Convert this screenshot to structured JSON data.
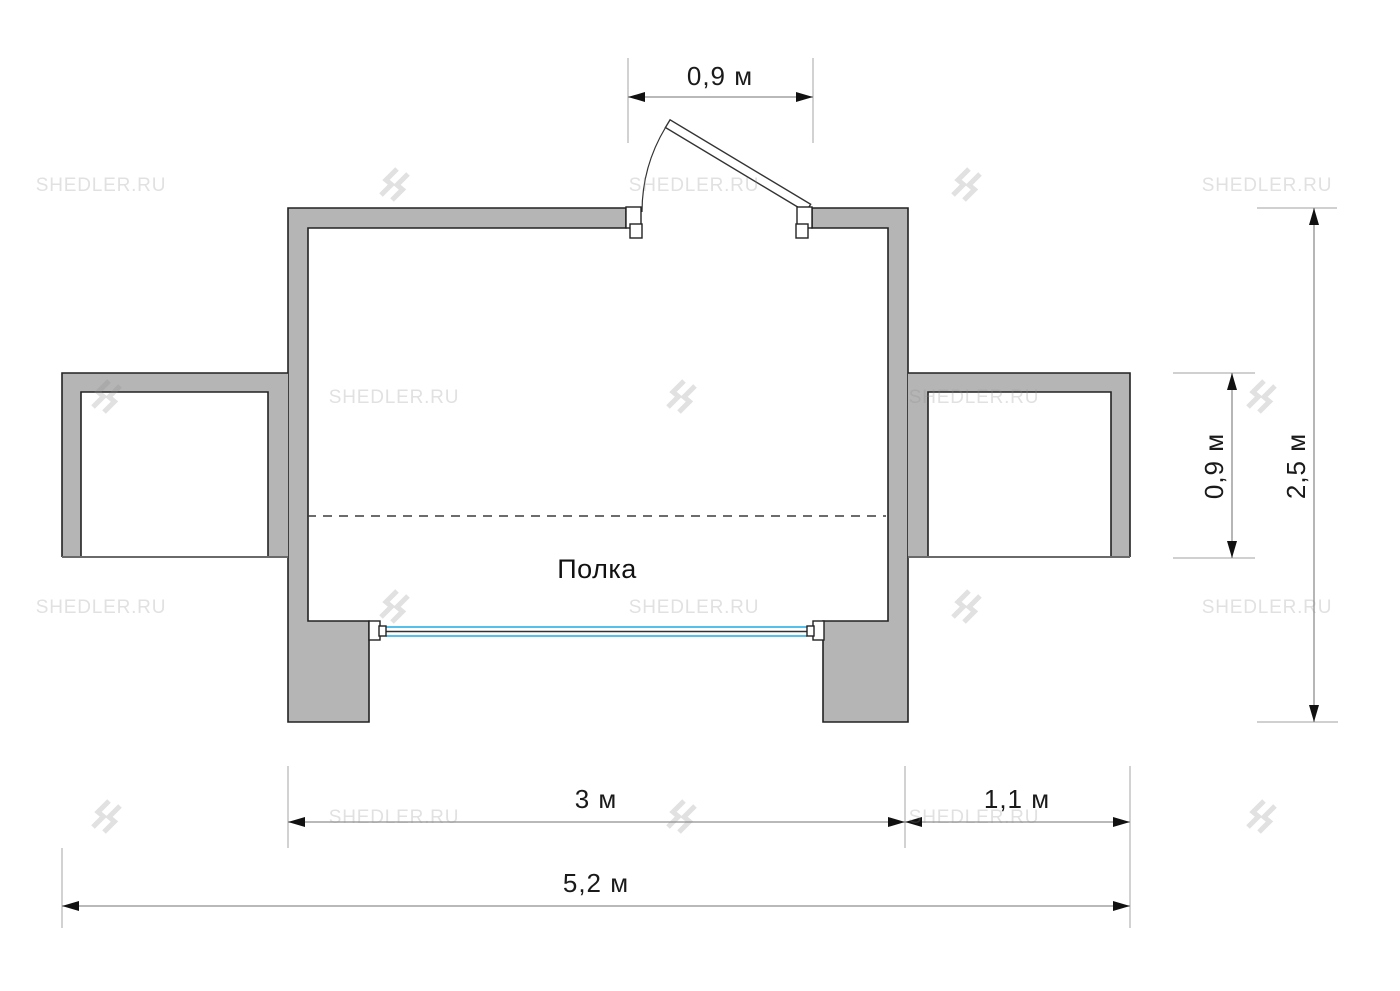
{
  "watermark": {
    "text": "SHEDLER.RU",
    "logo": "shedler-double-bolt-logo"
  },
  "plan": {
    "shelf_label": "Полка",
    "colors": {
      "wall_fill": "#b5b5b5",
      "wall_outline": "#222222",
      "open_edge_line": "#6a6a6a",
      "window_glass": "#55c0eb",
      "window_center_line": "#333333",
      "dashed_shelf_line": "#3c3c3c",
      "dimension_line": "#8f8f8f",
      "extension_line": "#b3b3b3",
      "arrow_and_text": "#1a1a1a",
      "watermark_gray": "#8a8a8a"
    }
  },
  "dimensions": {
    "door_width": {
      "label": "0,9 м"
    },
    "extension_depth": {
      "label": "0,9 м"
    },
    "overall_depth": {
      "label": "2,5 м"
    },
    "main_room_width": {
      "label": "3 м"
    },
    "right_extension_width": {
      "label": "1,1 м"
    },
    "overall_width": {
      "label": "5,2 м"
    }
  }
}
